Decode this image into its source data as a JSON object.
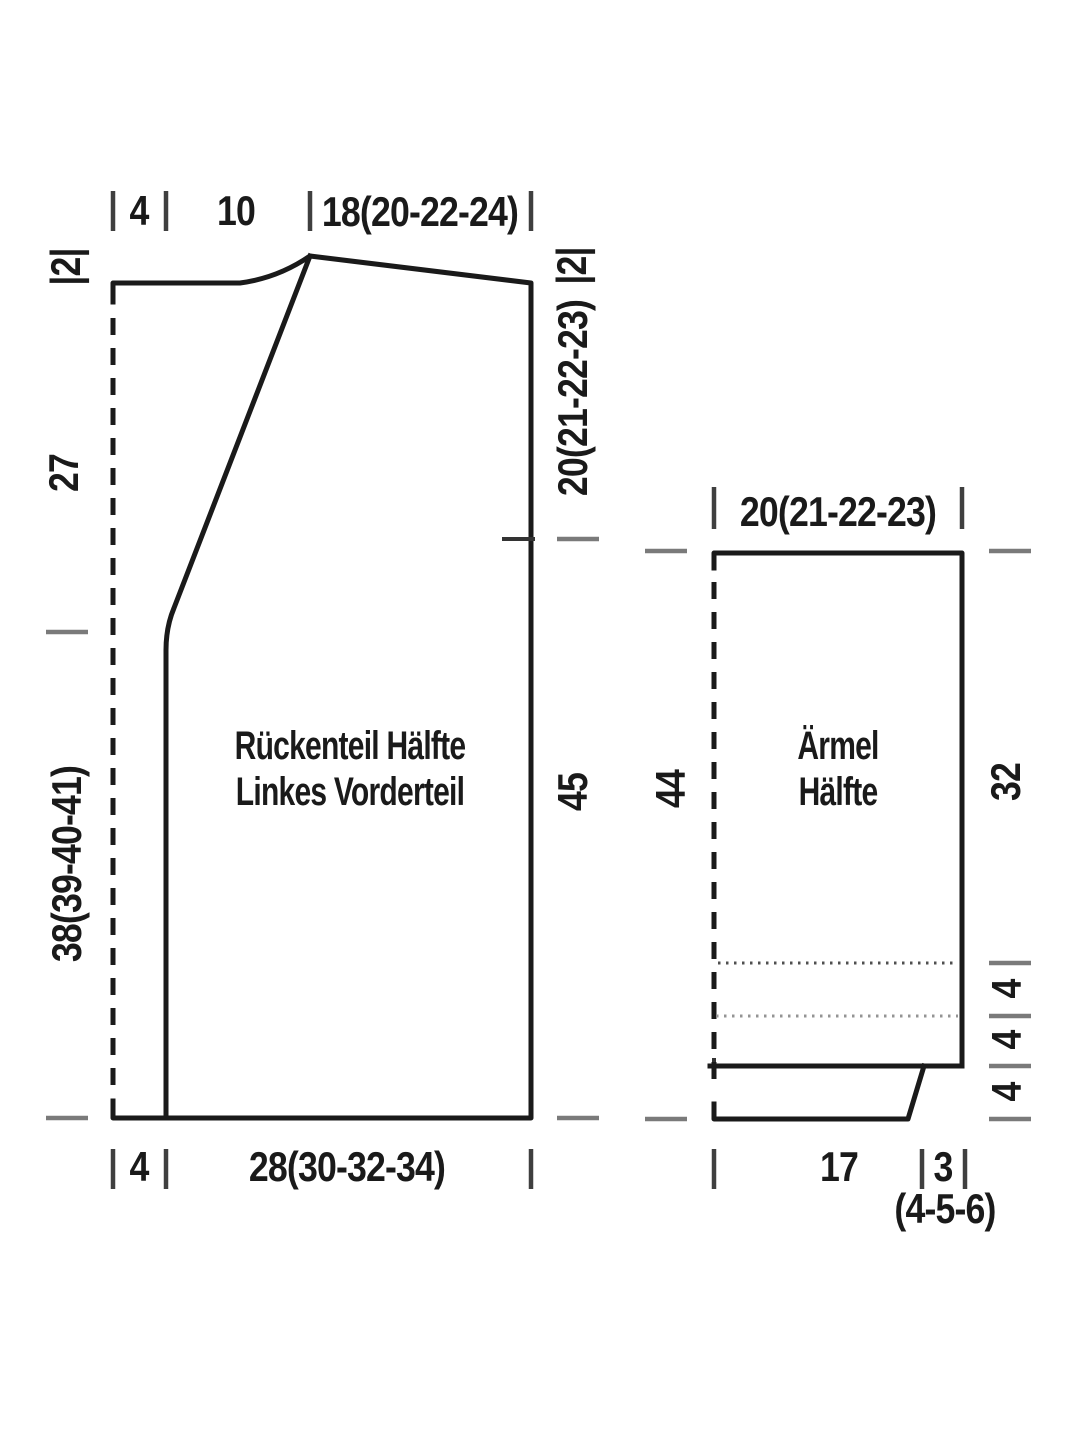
{
  "colors": {
    "line": "#1a1a1a",
    "ink": "#1a1a1a",
    "tickgray": "#7a7a7a",
    "tickdark": "#3f3f3f",
    "dot1": "#4f4f4f",
    "dot2": "#949494",
    "bg": "#ffffff"
  },
  "body_piece": {
    "name_line1": "Rückenteil Hälfte",
    "name_line2": "Linkes Vorderteil",
    "top": {
      "front_band": "4",
      "neck": "10",
      "shoulder": "18(20-22-24)"
    },
    "left": {
      "collar": "|2|",
      "upper": "27",
      "lower": "38(39-40-41)"
    },
    "right": {
      "collar": "|2|",
      "armhole": "20(21-22-23)",
      "side": "45"
    },
    "bottom": {
      "front_band": "4",
      "width": "28(30-32-34)"
    }
  },
  "sleeve_piece": {
    "name_line1": "Ärmel",
    "name_line2": "Hälfte",
    "top": {
      "width": "20(21-22-23)"
    },
    "left": {
      "length": "44"
    },
    "right": {
      "upper": "32",
      "seg1": "4",
      "seg2": "4",
      "seg3": "4"
    },
    "bottom": {
      "cuff": "17",
      "slant": "3",
      "slant_sizes": "(4-5-6)"
    }
  }
}
